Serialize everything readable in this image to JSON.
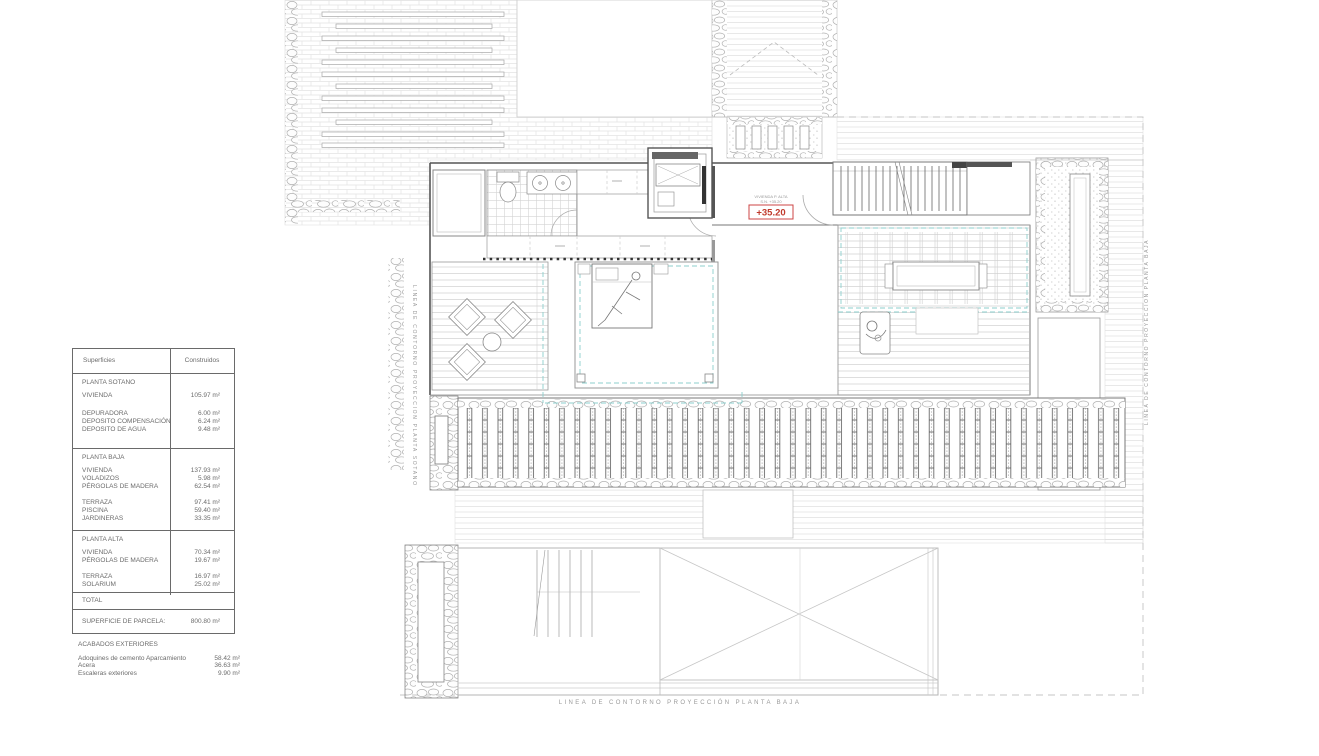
{
  "area_table": {
    "header_left": "Superficies",
    "header_right": "Construidos",
    "sotano_title": "PLANTA SOTANO",
    "sotano_rows": [
      {
        "label": "VIVIENDA",
        "value": "105.97 m²"
      },
      {
        "label": "DEPURADORA",
        "value": "6.00 m²"
      },
      {
        "label": "DEPOSITO COMPENSACIÓN",
        "value": "6.24 m²"
      },
      {
        "label": "DEPOSITO DE AGUA",
        "value": "9.48 m²"
      }
    ],
    "baja_title": "PLANTA BAJA",
    "baja_rows": [
      {
        "label": "VIVIENDA",
        "value": "137.93 m²"
      },
      {
        "label": "VOLADIZOS",
        "value": "5.98 m²"
      },
      {
        "label": "PÉRGOLAS DE MADERA",
        "value": "62.54 m²"
      },
      {
        "label": "TERRAZA",
        "value": "97.41 m²"
      },
      {
        "label": "PISCINA",
        "value": "59.40 m²"
      },
      {
        "label": "JARDINERAS",
        "value": "33.35 m²"
      }
    ],
    "alta_title": "PLANTA ALTA",
    "alta_rows": [
      {
        "label": "VIVIENDA",
        "value": "70.34 m²"
      },
      {
        "label": "PÉRGOLAS DE MADERA",
        "value": "19.67 m²"
      },
      {
        "label": "TERRAZA",
        "value": "16.97 m²"
      },
      {
        "label": "SOLARIUM",
        "value": "25.02 m²"
      }
    ],
    "total_label": "TOTAL",
    "parcel_label": "SUPERFICIE DE PARCELA:",
    "parcel_value": "800.80 m²"
  },
  "exterior_finishes": {
    "title": "ACABADOS EXTERIORES",
    "rows": [
      {
        "label": "Adoquines de cemento Aparcamiento",
        "value": "58.42 m²"
      },
      {
        "label": "Acera",
        "value": "36.63 m²"
      },
      {
        "label": "Escaleras exteriores",
        "value": "9.90 m²"
      }
    ]
  },
  "plan_labels": {
    "elevation": "+35.20",
    "elevation_note_line1": "VIVIENDA P. ALTA",
    "elevation_note_line2": "S.N. +35.20",
    "contour_left_vertical": "LINEA DE CONTORNO PROYECCION PLANTA SOTANO",
    "contour_right_vertical": "LINEA DE CONTORNO PROYECCION PLANTA BAJA",
    "contour_bottom": "LINEA DE CONTORNO PROYECCIÓN PLANTA BAJA"
  },
  "colors": {
    "accent_teal": "#8ccfce",
    "accent_red": "#c0392b",
    "line_gray": "#9a9a9a"
  }
}
